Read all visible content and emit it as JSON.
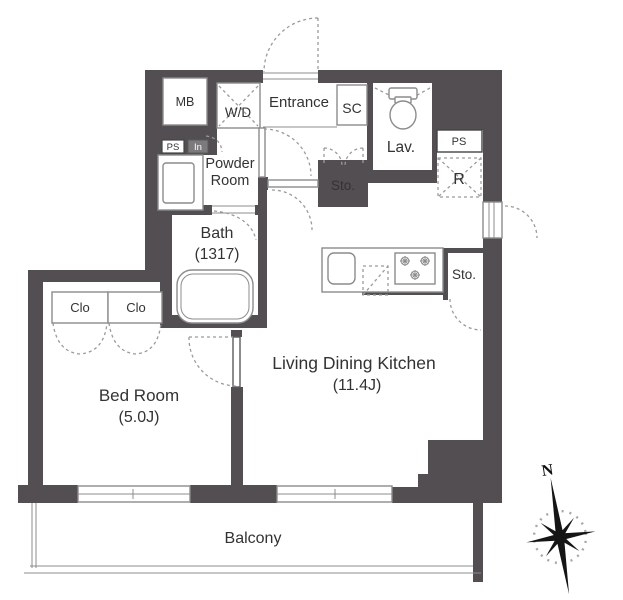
{
  "plan": {
    "rooms": {
      "entrance": "Entrance",
      "shoe_closet": "SC",
      "meter_box": "MB",
      "washer_dryer": "W/D",
      "powder_room_line1": "Powder",
      "powder_room_line2": "Room",
      "lavatory": "Lav.",
      "pipe_space_left": "PS",
      "intercom": "In",
      "pipe_space_right": "PS",
      "refrigerator": "R",
      "storage_hall": "Sto.",
      "storage_kitchen": "Sto.",
      "bath_label": "Bath",
      "bath_size": "(1317)",
      "bedroom_label": "Bed Room",
      "bedroom_size": "(5.0J)",
      "ldk_label": "Living Dining Kitchen",
      "ldk_size": "(11.4J)",
      "closet_left": "Clo",
      "closet_right": "Clo",
      "balcony": "Balcony"
    },
    "compass": {
      "north": "N"
    },
    "colors": {
      "wall": "#524e51",
      "line": "#8c8c8c",
      "dash": "#9b9b9b",
      "text": "#333333",
      "floor": "#ffffff"
    }
  }
}
